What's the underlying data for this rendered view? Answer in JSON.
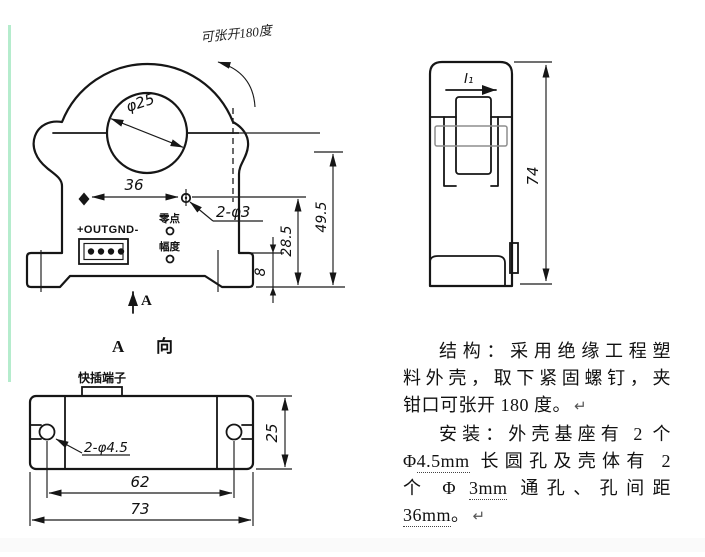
{
  "canvas": {
    "background": "#ffffff",
    "accent_line_color": "#b5eccd",
    "footer_tint": "#fafafa"
  },
  "front_view": {
    "open_note": "可张开180度",
    "diameter_label": "φ25",
    "dim_hole_spacing": "36",
    "holes_label": "2-φ3",
    "zero_label": "零点",
    "amplitude_label": "幅度",
    "connector_label": "+OUTGND-",
    "dim_base_step": "8",
    "dim_mid_height": "28.5",
    "dim_total_height": "49.5",
    "view_arrow_label": "A"
  },
  "side_view": {
    "current_label": "I₁",
    "dim_height": "74"
  },
  "bottom_view": {
    "title_letter": "A",
    "title_word": "向",
    "terminal_label": "快插端子",
    "slots_label": "2-φ4.5",
    "dim_slot_spacing": "62",
    "dim_total_width": "73",
    "dim_depth": "25"
  },
  "notes": {
    "l1": "结构：采用绝缘工程塑",
    "l2": "料外壳，取下紧固螺钉，夹",
    "l3": "钳口可张开 180 度。",
    "l4": "安装：外壳基座有 2 个",
    "l5a": "Φ",
    "l5b": "4.5mm",
    "l5c": " 长圆孔及壳体有 2",
    "l6a": "个 Φ ",
    "l6b": "3mm",
    "l6c": " 通孔、孔间距",
    "l7a": "36mm",
    "l7b": "。",
    "para_mark": "↵"
  }
}
